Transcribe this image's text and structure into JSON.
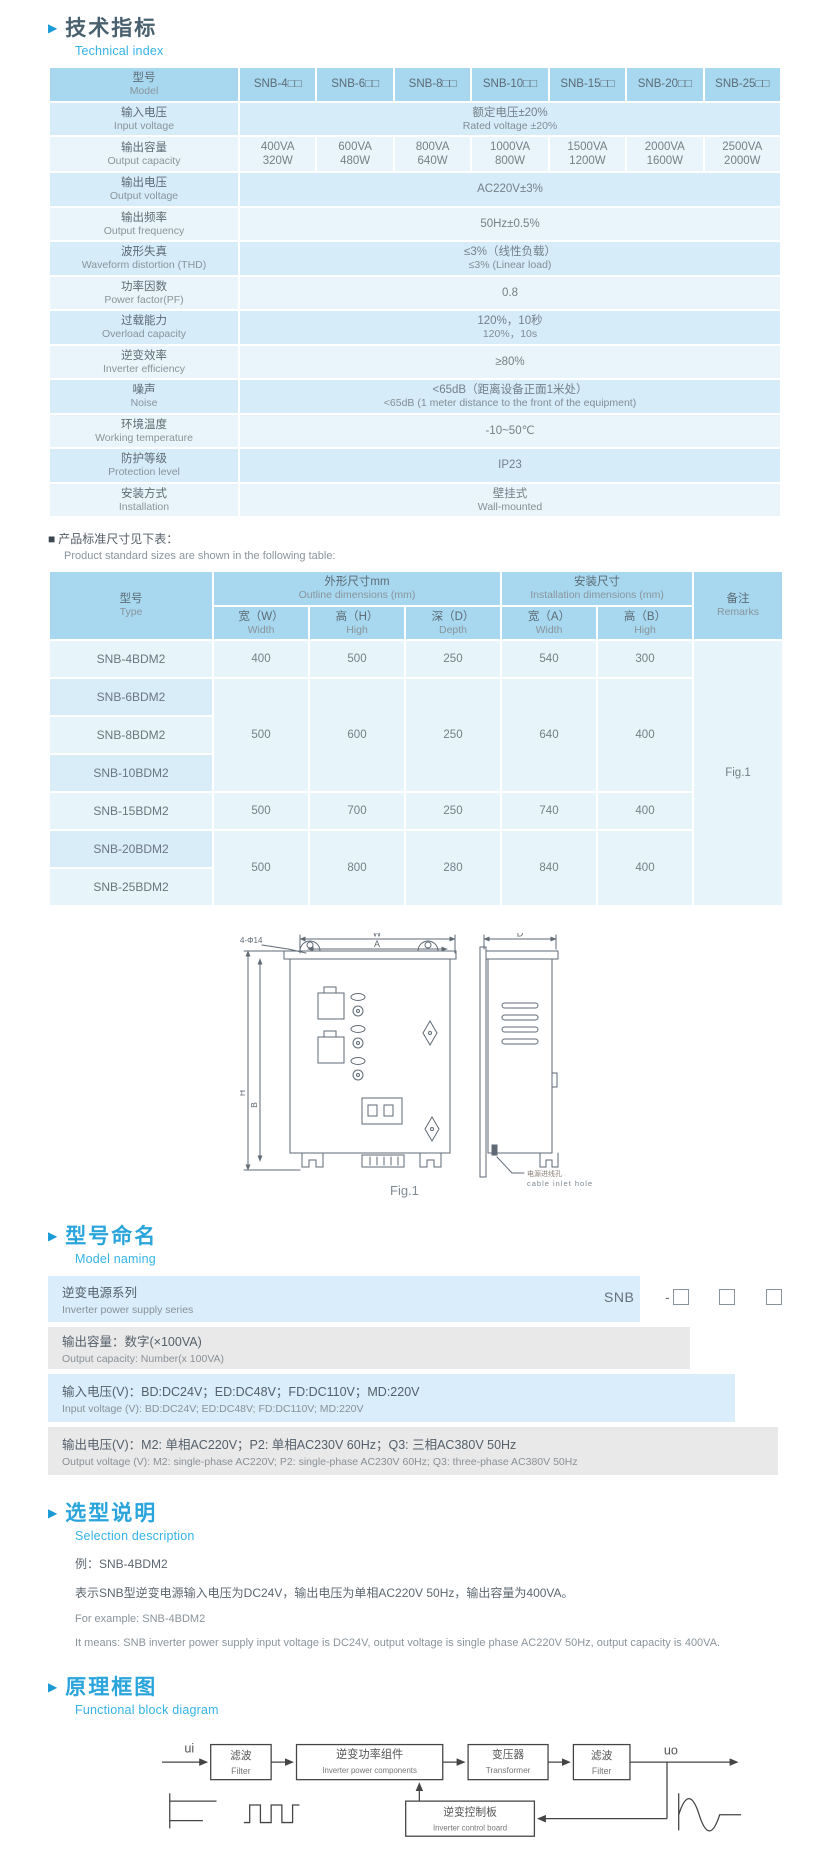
{
  "colors": {
    "accent_cyan": "#2aa5dc",
    "heading_dark": "#49606e",
    "table_header_bg": "#a7d8ef",
    "row_dark": "#d6ecf8",
    "row_light": "#e9f5fb",
    "naming_blue": "#d9eefa",
    "naming_gray": "#e9e9e9"
  },
  "glyphs": {
    "section_arrow": "▶",
    "note_bullet": "■"
  },
  "technical": {
    "title_zh": "技术指标",
    "title_en": "Technical index",
    "spec": {
      "model_zh": "型号",
      "model_en": "Model",
      "models": [
        "SNB-4□□",
        "SNB-6□□",
        "SNB-8□□",
        "SNB-10□□",
        "SNB-15□□",
        "SNB-20□□",
        "SNB-25□□"
      ],
      "rows": [
        {
          "zh": "输入电压",
          "en": "Input voltage",
          "v1": "额定电压±20%",
          "v2": "Rated voltage ±20%"
        },
        {
          "zh": "输出容量",
          "en": "Output capacity"
        },
        {
          "zh": "输出电压",
          "en": "Output voltage",
          "v1": "AC220V±3%"
        },
        {
          "zh": "输出频率",
          "en": "Output frequency",
          "v1": "50Hz±0.5%"
        },
        {
          "zh": "波形失真",
          "en": "Waveform distortion (THD)",
          "v1": "≤3%（线性负载）",
          "v2": "≤3% (Linear load)"
        },
        {
          "zh": "功率因数",
          "en": "Power factor(PF)",
          "v1": "0.8"
        },
        {
          "zh": "过载能力",
          "en": "Overload capacity",
          "v1": "120%，10秒",
          "v2": "120%，10s"
        },
        {
          "zh": "逆变效率",
          "en": "Inverter efficiency",
          "v1": "≥80%"
        },
        {
          "zh": "噪声",
          "en": "Noise",
          "v1": "<65dB（距离设备正面1米处）",
          "v2": "<65dB (1 meter distance to the front of the equipment)"
        },
        {
          "zh": "环境温度",
          "en": "Working temperature",
          "v1": "-10~50℃"
        },
        {
          "zh": "防护等级",
          "en": "Protection level",
          "v1": "IP23"
        },
        {
          "zh": "安装方式",
          "en": "Installation",
          "v1": "壁挂式",
          "v2": "Wall-mounted"
        }
      ],
      "capacity_va": [
        "400VA",
        "600VA",
        "800VA",
        "1000VA",
        "1500VA",
        "2000VA",
        "2500VA"
      ],
      "capacity_w": [
        "320W",
        "480W",
        "640W",
        "800W",
        "1200W",
        "1600W",
        "2000W"
      ]
    },
    "note_zh": "产品标准尺寸见下表：",
    "note_en": "Product standard sizes are shown in the following table:",
    "size_table": {
      "type_zh": "型号",
      "type_en": "Type",
      "outline_zh": "外形尺寸mm",
      "outline_en": "Outline dimensions (mm)",
      "install_zh": "安装尺寸",
      "install_en": "Installation dimensions (mm)",
      "remarks_zh": "备注",
      "remarks_en": "Remarks",
      "w_zh": "宽（W）",
      "w_en": "Width",
      "h_zh": "高（H）",
      "h_en": "High",
      "d_zh": "深（D）",
      "d_en": "Depth",
      "a_zh": "宽（A）",
      "a_en": "Width",
      "b_zh": "高（B）",
      "b_en": "High",
      "models": [
        "SNB-4BDM2",
        "SNB-6BDM2",
        "SNB-8BDM2",
        "SNB-10BDM2",
        "SNB-15BDM2",
        "SNB-20BDM2",
        "SNB-25BDM2"
      ],
      "g1": {
        "w": "400",
        "h": "500",
        "d": "250",
        "a": "540",
        "b": "300"
      },
      "g2": {
        "w": "500",
        "h": "600",
        "d": "250",
        "a": "640",
        "b": "400"
      },
      "g3": {
        "w": "500",
        "h": "700",
        "d": "250",
        "a": "740",
        "b": "400"
      },
      "g4": {
        "w": "500",
        "h": "800",
        "d": "280",
        "a": "840",
        "b": "400"
      },
      "remark": "Fig.1"
    }
  },
  "figure": {
    "caption": "Fig.1",
    "dim_w": "W",
    "dim_a": "A",
    "dim_d": "D",
    "dim_h": "H",
    "dim_b": "B",
    "holes": "4-Φ14",
    "inlet_zh": "电源进线孔",
    "inlet_en": "cable inlet hole"
  },
  "naming": {
    "title_zh": "型号命名",
    "title_en": "Model naming",
    "code_prefix": "SNB",
    "code_dash": "-",
    "rows": [
      {
        "zh": "逆变电源系列",
        "en": "Inverter power supply series"
      },
      {
        "zh": "输出容量：数字(×100VA)",
        "en": "Output capacity: Number(x 100VA)"
      },
      {
        "zh": "输入电压(V)：BD:DC24V；ED:DC48V；FD:DC110V；MD:220V",
        "en": "Input voltage (V): BD:DC24V;  ED:DC48V;  FD:DC110V; MD:220V"
      },
      {
        "zh": "输出电压(V)：M2: 单相AC220V；P2: 单相AC230V 60Hz；Q3: 三相AC380V 50Hz",
        "en": "Output voltage (V): M2: single-phase AC220V;  P2: single-phase AC230V 60Hz;  Q3: three-phase AC380V 50Hz"
      }
    ]
  },
  "selection": {
    "title_zh": "选型说明",
    "title_en": "Selection description",
    "example_zh": "例：SNB-4BDM2",
    "desc_zh": "表示SNB型逆变电源输入电压为DC24V，输出电压为单相AC220V 50Hz，输出容量为400VA。",
    "example_en": "For example: SNB-4BDM2",
    "desc_en": "It means: SNB inverter power supply input voltage is DC24V, output voltage is single phase AC220V 50Hz, output capacity is 400VA."
  },
  "blockdiagram": {
    "title_zh": "原理框图",
    "title_en": "Functional block diagram",
    "input_label": "ui",
    "output_label": "uo",
    "boxes": [
      {
        "zh": "滤波",
        "en": "Filter"
      },
      {
        "zh": "逆变功率组件",
        "en": "Inverter power components"
      },
      {
        "zh": "变压器",
        "en": "Transformer"
      },
      {
        "zh": "滤波",
        "en": "Filter"
      },
      {
        "zh": "逆变控制板",
        "en": "Inverter control board"
      }
    ]
  }
}
